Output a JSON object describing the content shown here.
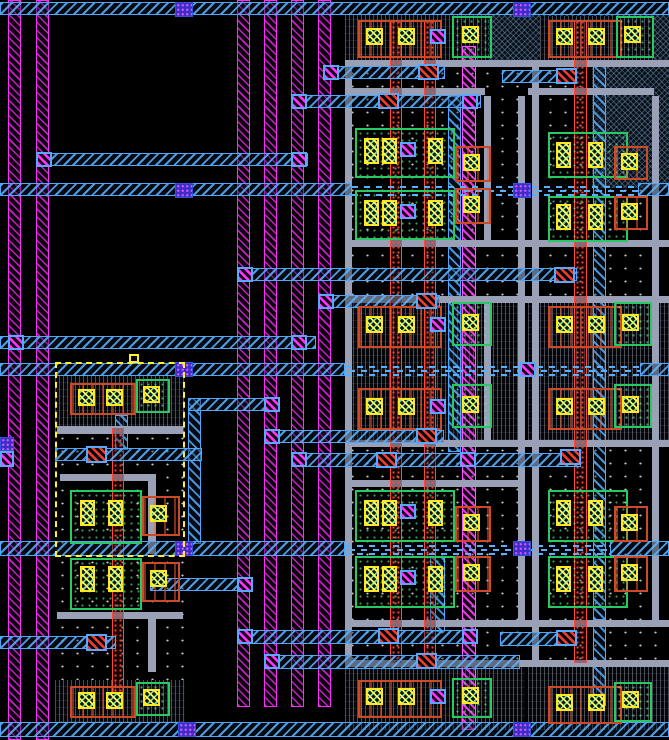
{
  "app": {
    "name": "vlsi-layout-editor-canvas"
  },
  "canvas": {
    "w": 669,
    "h": 740,
    "background": "#000000"
  },
  "palette": {
    "metal1_magenta": "#ff2bff",
    "metal2_cyan": "#4fa8ff",
    "metal3_dash": "#57b0ff",
    "gray_rail": "#9aa0b6",
    "poly_red": "#ff4838",
    "pdiff_orange": "#cc4a26",
    "ndiff_green": "#27c960",
    "contact_yellow": "#ffe81f",
    "via_magenta": "#ff35ff",
    "via2_blue": "#3d2ec8",
    "selection_yellow": "#ffee33",
    "background": "#000000"
  },
  "sizes": {
    "contact": [
      17,
      17
    ],
    "ct": [
      15,
      26
    ],
    "via": [
      16,
      15
    ],
    "redc": [
      21,
      16
    ],
    "bluesq": [
      18,
      15
    ],
    "handle": [
      10,
      9
    ]
  },
  "names": {
    "stipple": "well-region",
    "vhatch": "cell-active-region",
    "bluecross": "nwell-hatch-region",
    "mstripe": "metal1-stripe",
    "mstrip": "metal1-strap",
    "crail": "metal2-rail",
    "cstrip": "metal2-strap",
    "dash": "metal3-tracks",
    "gray": "metal-rail-gray",
    "redcol": "poly-column",
    "obox": "pdiff-region",
    "gbox": "ndiff-region",
    "contact": "diffusion-contact",
    "ct": "diffusion-contact-tall",
    "via": "via-contact",
    "redc": "poly-contact",
    "bluesq": "via2-stack",
    "sel": "selection-box",
    "handle": "selection-handle"
  },
  "shapes": [
    {
      "t": "stipple",
      "x": 345,
      "y": 15,
      "w": 180,
      "h": 715
    },
    {
      "t": "stipple",
      "x": 528,
      "y": 15,
      "w": 141,
      "h": 715
    },
    {
      "t": "stipple",
      "x": 55,
      "y": 432,
      "w": 130,
      "h": 124
    },
    {
      "t": "stipple",
      "x": 55,
      "y": 556,
      "w": 130,
      "h": 124
    },
    {
      "t": "vhatch",
      "x": 55,
      "y": 375,
      "w": 130,
      "h": 57
    },
    {
      "t": "vhatch",
      "x": 55,
      "y": 680,
      "w": 130,
      "h": 42
    },
    {
      "t": "vhatch",
      "x": 345,
      "y": 15,
      "w": 180,
      "h": 47
    },
    {
      "t": "vhatch",
      "x": 345,
      "y": 298,
      "w": 180,
      "h": 142
    },
    {
      "t": "vhatch",
      "x": 345,
      "y": 663,
      "w": 180,
      "h": 67
    },
    {
      "t": "bluecross",
      "x": 488,
      "y": 15,
      "w": 181,
      "h": 47
    },
    {
      "t": "vhatch",
      "x": 540,
      "y": 16,
      "w": 114,
      "h": 46
    },
    {
      "t": "vhatch",
      "x": 528,
      "y": 298,
      "w": 141,
      "h": 142
    },
    {
      "t": "vhatch",
      "x": 528,
      "y": 663,
      "w": 141,
      "h": 67
    },
    {
      "t": "bluecross",
      "x": 592,
      "y": 66,
      "w": 77,
      "h": 122
    },
    {
      "t": "mstripe",
      "x": 8,
      "y": 0,
      "w": 13,
      "h": 740
    },
    {
      "t": "mstripe",
      "x": 36,
      "y": 0,
      "w": 13,
      "h": 740
    },
    {
      "t": "mstripe",
      "x": 237,
      "y": 0,
      "w": 13,
      "h": 707
    },
    {
      "t": "mstripe",
      "x": 264,
      "y": 0,
      "w": 13,
      "h": 707
    },
    {
      "t": "mstripe",
      "x": 291,
      "y": 0,
      "w": 13,
      "h": 707
    },
    {
      "t": "mstripe",
      "x": 318,
      "y": 0,
      "w": 13,
      "h": 707
    },
    {
      "t": "mstrip",
      "x": 462,
      "y": 46,
      "w": 14,
      "h": 684
    },
    {
      "t": "cstrip",
      "x": 188,
      "y": 398,
      "w": 13,
      "h": 146
    },
    {
      "t": "cstrip",
      "x": 115,
      "y": 415,
      "w": 13,
      "h": 35
    },
    {
      "t": "cstrip",
      "x": 448,
      "y": 96,
      "w": 13,
      "h": 356
    },
    {
      "t": "cstrip",
      "x": 430,
      "y": 556,
      "w": 15,
      "h": 76
    },
    {
      "t": "cstrip",
      "x": 593,
      "y": 62,
      "w": 13,
      "h": 558
    },
    {
      "t": "cstrip",
      "x": 593,
      "y": 622,
      "w": 13,
      "h": 84
    },
    {
      "t": "gray",
      "x": 57,
      "y": 426,
      "w": 126,
      "h": 8
    },
    {
      "t": "gray",
      "x": 60,
      "y": 474,
      "w": 92,
      "h": 7
    },
    {
      "t": "gray",
      "x": 148,
      "y": 474,
      "w": 8,
      "h": 80
    },
    {
      "t": "gray",
      "x": 57,
      "y": 612,
      "w": 126,
      "h": 7
    },
    {
      "t": "gray",
      "x": 148,
      "y": 612,
      "w": 8,
      "h": 60
    },
    {
      "t": "gray",
      "x": 345,
      "y": 60,
      "w": 324,
      "h": 7
    },
    {
      "t": "gray",
      "x": 345,
      "y": 88,
      "w": 140,
      "h": 7
    },
    {
      "t": "gray",
      "x": 528,
      "y": 88,
      "w": 126,
      "h": 7
    },
    {
      "t": "gray",
      "x": 345,
      "y": 240,
      "w": 324,
      "h": 7
    },
    {
      "t": "gray",
      "x": 345,
      "y": 296,
      "w": 324,
      "h": 7
    },
    {
      "t": "gray",
      "x": 345,
      "y": 440,
      "w": 324,
      "h": 7
    },
    {
      "t": "gray",
      "x": 345,
      "y": 480,
      "w": 178,
      "h": 7
    },
    {
      "t": "gray",
      "x": 345,
      "y": 620,
      "w": 324,
      "h": 7
    },
    {
      "t": "gray",
      "x": 345,
      "y": 660,
      "w": 324,
      "h": 7
    },
    {
      "t": "gray",
      "x": 345,
      "y": 60,
      "w": 7,
      "h": 607
    },
    {
      "t": "gray",
      "x": 518,
      "y": 96,
      "w": 7,
      "h": 524
    },
    {
      "t": "gray",
      "x": 532,
      "y": 60,
      "w": 7,
      "h": 607
    },
    {
      "t": "gray",
      "x": 652,
      "y": 96,
      "w": 7,
      "h": 524
    },
    {
      "t": "gray",
      "x": 484,
      "y": 96,
      "w": 7,
      "h": 146
    },
    {
      "t": "gray",
      "x": 484,
      "y": 300,
      "w": 7,
      "h": 140
    },
    {
      "t": "redcol",
      "x": 390,
      "y": 20,
      "w": 12,
      "h": 643
    },
    {
      "t": "redcol",
      "x": 424,
      "y": 20,
      "w": 12,
      "h": 643
    },
    {
      "t": "redcol",
      "x": 574,
      "y": 20,
      "w": 13,
      "h": 643
    },
    {
      "t": "redcol",
      "x": 112,
      "y": 428,
      "w": 12,
      "h": 264
    },
    {
      "t": "crail",
      "x": 36,
      "y": 153,
      "w": 272,
      "h": 13
    },
    {
      "t": "crail",
      "x": 0,
      "y": 336,
      "w": 316,
      "h": 13
    },
    {
      "t": "crail",
      "x": 323,
      "y": 66,
      "w": 122,
      "h": 13
    },
    {
      "t": "crail",
      "x": 502,
      "y": 70,
      "w": 62,
      "h": 13
    },
    {
      "t": "crail",
      "x": 291,
      "y": 95,
      "w": 190,
      "h": 13
    },
    {
      "t": "crail",
      "x": 237,
      "y": 268,
      "w": 340,
      "h": 13
    },
    {
      "t": "crail",
      "x": 318,
      "y": 295,
      "w": 122,
      "h": 13
    },
    {
      "t": "crail",
      "x": 188,
      "y": 398,
      "w": 92,
      "h": 13
    },
    {
      "t": "crail",
      "x": 264,
      "y": 430,
      "w": 180,
      "h": 13
    },
    {
      "t": "crail",
      "x": 55,
      "y": 448,
      "w": 147,
      "h": 13
    },
    {
      "t": "crail",
      "x": 291,
      "y": 453,
      "w": 290,
      "h": 14
    },
    {
      "t": "crail",
      "x": 150,
      "y": 578,
      "w": 100,
      "h": 13
    },
    {
      "t": "crail",
      "x": 0,
      "y": 636,
      "w": 116,
      "h": 13
    },
    {
      "t": "crail",
      "x": 237,
      "y": 630,
      "w": 240,
      "h": 14
    },
    {
      "t": "crail",
      "x": 264,
      "y": 655,
      "w": 256,
      "h": 14
    },
    {
      "t": "crail",
      "x": 500,
      "y": 632,
      "w": 70,
      "h": 14
    },
    {
      "t": "crail",
      "x": 0,
      "y": 2,
      "w": 669,
      "h": 13
    },
    {
      "t": "crail",
      "x": 0,
      "y": 183,
      "w": 352,
      "h": 13
    },
    {
      "t": "crail",
      "x": 638,
      "y": 183,
      "w": 31,
      "h": 13
    },
    {
      "t": "crail",
      "x": 0,
      "y": 363,
      "w": 345,
      "h": 13
    },
    {
      "t": "crail",
      "x": 640,
      "y": 363,
      "w": 29,
      "h": 13
    },
    {
      "t": "crail",
      "x": 0,
      "y": 541,
      "w": 345,
      "h": 15
    },
    {
      "t": "crail",
      "x": 610,
      "y": 541,
      "w": 59,
      "h": 15
    },
    {
      "t": "crail",
      "x": 0,
      "y": 722,
      "w": 669,
      "h": 15
    },
    {
      "t": "dash",
      "x": 352,
      "y": 186,
      "w": 286,
      "h": 10
    },
    {
      "t": "dash",
      "x": 345,
      "y": 366,
      "w": 295,
      "h": 10
    },
    {
      "t": "dash",
      "x": 345,
      "y": 545,
      "w": 265,
      "h": 10
    },
    {
      "t": "obox",
      "x": 70,
      "y": 383,
      "w": 66,
      "h": 32
    },
    {
      "t": "contact",
      "x": 78,
      "y": 389
    },
    {
      "t": "contact",
      "x": 106,
      "y": 389
    },
    {
      "t": "gbox",
      "x": 136,
      "y": 379,
      "w": 34,
      "h": 34
    },
    {
      "t": "contact",
      "x": 143,
      "y": 386
    },
    {
      "t": "gbox",
      "x": 70,
      "y": 490,
      "w": 72,
      "h": 54
    },
    {
      "t": "ct",
      "x": 80,
      "y": 500
    },
    {
      "t": "ct",
      "x": 108,
      "y": 500
    },
    {
      "t": "obox",
      "x": 142,
      "y": 496,
      "w": 38,
      "h": 40
    },
    {
      "t": "contact",
      "x": 150,
      "y": 505
    },
    {
      "t": "gbox",
      "x": 70,
      "y": 558,
      "w": 72,
      "h": 52
    },
    {
      "t": "ct",
      "x": 80,
      "y": 566
    },
    {
      "t": "ct",
      "x": 108,
      "y": 566
    },
    {
      "t": "obox",
      "x": 142,
      "y": 562,
      "w": 38,
      "h": 40
    },
    {
      "t": "contact",
      "x": 150,
      "y": 570
    },
    {
      "t": "obox",
      "x": 70,
      "y": 686,
      "w": 66,
      "h": 32
    },
    {
      "t": "contact",
      "x": 78,
      "y": 692
    },
    {
      "t": "contact",
      "x": 106,
      "y": 692
    },
    {
      "t": "gbox",
      "x": 136,
      "y": 682,
      "w": 34,
      "h": 34
    },
    {
      "t": "contact",
      "x": 143,
      "y": 689
    },
    {
      "t": "obox",
      "x": 358,
      "y": 20,
      "w": 84,
      "h": 38
    },
    {
      "t": "contact",
      "x": 366,
      "y": 28
    },
    {
      "t": "contact",
      "x": 398,
      "y": 28
    },
    {
      "t": "via",
      "x": 430,
      "y": 29
    },
    {
      "t": "gbox",
      "x": 452,
      "y": 16,
      "w": 40,
      "h": 42
    },
    {
      "t": "contact",
      "x": 462,
      "y": 26
    },
    {
      "t": "gbox",
      "x": 355,
      "y": 128,
      "w": 100,
      "h": 50
    },
    {
      "t": "ct",
      "x": 364,
      "y": 138
    },
    {
      "t": "ct",
      "x": 382,
      "y": 138
    },
    {
      "t": "ct",
      "x": 428,
      "y": 138
    },
    {
      "t": "via",
      "x": 400,
      "y": 142
    },
    {
      "t": "obox",
      "x": 455,
      "y": 146,
      "w": 36,
      "h": 36
    },
    {
      "t": "contact",
      "x": 463,
      "y": 154
    },
    {
      "t": "gbox",
      "x": 355,
      "y": 190,
      "w": 100,
      "h": 50
    },
    {
      "t": "ct",
      "x": 364,
      "y": 200
    },
    {
      "t": "ct",
      "x": 382,
      "y": 200
    },
    {
      "t": "ct",
      "x": 428,
      "y": 200
    },
    {
      "t": "via",
      "x": 400,
      "y": 204
    },
    {
      "t": "obox",
      "x": 455,
      "y": 188,
      "w": 36,
      "h": 36
    },
    {
      "t": "contact",
      "x": 463,
      "y": 196
    },
    {
      "t": "obox",
      "x": 358,
      "y": 306,
      "w": 84,
      "h": 42
    },
    {
      "t": "contact",
      "x": 366,
      "y": 316
    },
    {
      "t": "contact",
      "x": 398,
      "y": 316
    },
    {
      "t": "via",
      "x": 430,
      "y": 317
    },
    {
      "t": "gbox",
      "x": 452,
      "y": 302,
      "w": 40,
      "h": 44
    },
    {
      "t": "contact",
      "x": 462,
      "y": 314
    },
    {
      "t": "obox",
      "x": 358,
      "y": 388,
      "w": 84,
      "h": 42
    },
    {
      "t": "contact",
      "x": 366,
      "y": 398
    },
    {
      "t": "contact",
      "x": 398,
      "y": 398
    },
    {
      "t": "via",
      "x": 430,
      "y": 399
    },
    {
      "t": "gbox",
      "x": 452,
      "y": 384,
      "w": 40,
      "h": 44
    },
    {
      "t": "contact",
      "x": 462,
      "y": 396
    },
    {
      "t": "gbox",
      "x": 355,
      "y": 490,
      "w": 100,
      "h": 52
    },
    {
      "t": "ct",
      "x": 364,
      "y": 500
    },
    {
      "t": "ct",
      "x": 382,
      "y": 500
    },
    {
      "t": "ct",
      "x": 428,
      "y": 500
    },
    {
      "t": "via",
      "x": 400,
      "y": 504
    },
    {
      "t": "obox",
      "x": 455,
      "y": 506,
      "w": 36,
      "h": 36
    },
    {
      "t": "contact",
      "x": 463,
      "y": 514
    },
    {
      "t": "gbox",
      "x": 355,
      "y": 556,
      "w": 100,
      "h": 52
    },
    {
      "t": "ct",
      "x": 364,
      "y": 566
    },
    {
      "t": "ct",
      "x": 382,
      "y": 566
    },
    {
      "t": "ct",
      "x": 428,
      "y": 566
    },
    {
      "t": "via",
      "x": 400,
      "y": 570
    },
    {
      "t": "obox",
      "x": 455,
      "y": 556,
      "w": 36,
      "h": 36
    },
    {
      "t": "contact",
      "x": 463,
      "y": 564
    },
    {
      "t": "obox",
      "x": 358,
      "y": 680,
      "w": 84,
      "h": 38
    },
    {
      "t": "contact",
      "x": 366,
      "y": 688
    },
    {
      "t": "contact",
      "x": 398,
      "y": 688
    },
    {
      "t": "via",
      "x": 430,
      "y": 689
    },
    {
      "t": "gbox",
      "x": 452,
      "y": 678,
      "w": 40,
      "h": 40
    },
    {
      "t": "contact",
      "x": 462,
      "y": 687
    },
    {
      "t": "obox",
      "x": 548,
      "y": 20,
      "w": 74,
      "h": 38
    },
    {
      "t": "contact",
      "x": 556,
      "y": 28
    },
    {
      "t": "contact",
      "x": 588,
      "y": 28
    },
    {
      "t": "gbox",
      "x": 616,
      "y": 16,
      "w": 38,
      "h": 42
    },
    {
      "t": "contact",
      "x": 624,
      "y": 26
    },
    {
      "t": "gbox",
      "x": 548,
      "y": 132,
      "w": 80,
      "h": 46
    },
    {
      "t": "ct",
      "x": 556,
      "y": 142
    },
    {
      "t": "ct",
      "x": 588,
      "y": 142
    },
    {
      "t": "obox",
      "x": 614,
      "y": 146,
      "w": 34,
      "h": 34
    },
    {
      "t": "contact",
      "x": 621,
      "y": 153
    },
    {
      "t": "gbox",
      "x": 548,
      "y": 196,
      "w": 80,
      "h": 46
    },
    {
      "t": "ct",
      "x": 556,
      "y": 204
    },
    {
      "t": "ct",
      "x": 588,
      "y": 204
    },
    {
      "t": "obox",
      "x": 614,
      "y": 196,
      "w": 34,
      "h": 34
    },
    {
      "t": "contact",
      "x": 621,
      "y": 203
    },
    {
      "t": "obox",
      "x": 548,
      "y": 306,
      "w": 74,
      "h": 42
    },
    {
      "t": "contact",
      "x": 556,
      "y": 316
    },
    {
      "t": "contact",
      "x": 588,
      "y": 316
    },
    {
      "t": "gbox",
      "x": 614,
      "y": 302,
      "w": 38,
      "h": 44
    },
    {
      "t": "contact",
      "x": 622,
      "y": 314
    },
    {
      "t": "obox",
      "x": 548,
      "y": 388,
      "w": 74,
      "h": 42
    },
    {
      "t": "contact",
      "x": 556,
      "y": 398
    },
    {
      "t": "contact",
      "x": 588,
      "y": 398
    },
    {
      "t": "gbox",
      "x": 614,
      "y": 384,
      "w": 38,
      "h": 44
    },
    {
      "t": "contact",
      "x": 622,
      "y": 396
    },
    {
      "t": "gbox",
      "x": 548,
      "y": 490,
      "w": 80,
      "h": 52
    },
    {
      "t": "ct",
      "x": 556,
      "y": 500
    },
    {
      "t": "ct",
      "x": 588,
      "y": 500
    },
    {
      "t": "obox",
      "x": 614,
      "y": 506,
      "w": 34,
      "h": 36
    },
    {
      "t": "contact",
      "x": 621,
      "y": 514
    },
    {
      "t": "gbox",
      "x": 548,
      "y": 556,
      "w": 80,
      "h": 52
    },
    {
      "t": "ct",
      "x": 556,
      "y": 566
    },
    {
      "t": "ct",
      "x": 588,
      "y": 566
    },
    {
      "t": "obox",
      "x": 614,
      "y": 556,
      "w": 34,
      "h": 36
    },
    {
      "t": "contact",
      "x": 621,
      "y": 564
    },
    {
      "t": "obox",
      "x": 548,
      "y": 686,
      "w": 74,
      "h": 38
    },
    {
      "t": "contact",
      "x": 556,
      "y": 694
    },
    {
      "t": "contact",
      "x": 588,
      "y": 694
    },
    {
      "t": "gbox",
      "x": 614,
      "y": 682,
      "w": 38,
      "h": 40
    },
    {
      "t": "contact",
      "x": 622,
      "y": 691
    },
    {
      "t": "via",
      "x": 36,
      "y": 152
    },
    {
      "t": "via",
      "x": 291,
      "y": 152
    },
    {
      "t": "via",
      "x": 323,
      "y": 65
    },
    {
      "t": "via",
      "x": 291,
      "y": 94
    },
    {
      "t": "via",
      "x": 462,
      "y": 94
    },
    {
      "t": "via",
      "x": 237,
      "y": 267
    },
    {
      "t": "via",
      "x": 318,
      "y": 294
    },
    {
      "t": "via",
      "x": 8,
      "y": 335
    },
    {
      "t": "via",
      "x": 291,
      "y": 335
    },
    {
      "t": "via",
      "x": 264,
      "y": 397
    },
    {
      "t": "via",
      "x": 264,
      "y": 429
    },
    {
      "t": "via",
      "x": 291,
      "y": 452
    },
    {
      "t": "via",
      "x": 460,
      "y": 452
    },
    {
      "t": "via",
      "x": 237,
      "y": 577
    },
    {
      "t": "via",
      "x": 237,
      "y": 629
    },
    {
      "t": "via",
      "x": 462,
      "y": 629
    },
    {
      "t": "via",
      "x": 264,
      "y": 654
    },
    {
      "t": "via",
      "x": 520,
      "y": 362
    },
    {
      "t": "via",
      "x": 0,
      "y": 451,
      "w": 14,
      "h": 16
    },
    {
      "t": "redc",
      "x": 418,
      "y": 64
    },
    {
      "t": "redc",
      "x": 556,
      "y": 68
    },
    {
      "t": "redc",
      "x": 378,
      "y": 93
    },
    {
      "t": "redc",
      "x": 554,
      "y": 267
    },
    {
      "t": "redc",
      "x": 416,
      "y": 293
    },
    {
      "t": "redc",
      "x": 416,
      "y": 428
    },
    {
      "t": "redc",
      "x": 376,
      "y": 452
    },
    {
      "t": "redc",
      "x": 560,
      "y": 449
    },
    {
      "t": "redc",
      "x": 86,
      "y": 446,
      "w": 21,
      "h": 17
    },
    {
      "t": "redc",
      "x": 86,
      "y": 634,
      "w": 21,
      "h": 17
    },
    {
      "t": "redc",
      "x": 378,
      "y": 628
    },
    {
      "t": "redc",
      "x": 416,
      "y": 653
    },
    {
      "t": "redc",
      "x": 556,
      "y": 630
    },
    {
      "t": "bluesq",
      "x": 175,
      "y": 2
    },
    {
      "t": "bluesq",
      "x": 513,
      "y": 2
    },
    {
      "t": "bluesq",
      "x": 175,
      "y": 183
    },
    {
      "t": "bluesq",
      "x": 513,
      "y": 183
    },
    {
      "t": "bluesq",
      "x": 175,
      "y": 362
    },
    {
      "t": "bluesq",
      "x": 175,
      "y": 541
    },
    {
      "t": "bluesq",
      "x": 513,
      "y": 541
    },
    {
      "t": "bluesq",
      "x": 178,
      "y": 722
    },
    {
      "t": "bluesq",
      "x": 513,
      "y": 722
    },
    {
      "t": "bluesq",
      "x": 0,
      "y": 437,
      "w": 14,
      "h": 14
    },
    {
      "t": "sel",
      "x": 55,
      "y": 362,
      "w": 130,
      "h": 195
    },
    {
      "t": "handle",
      "x": 129,
      "y": 354
    }
  ]
}
